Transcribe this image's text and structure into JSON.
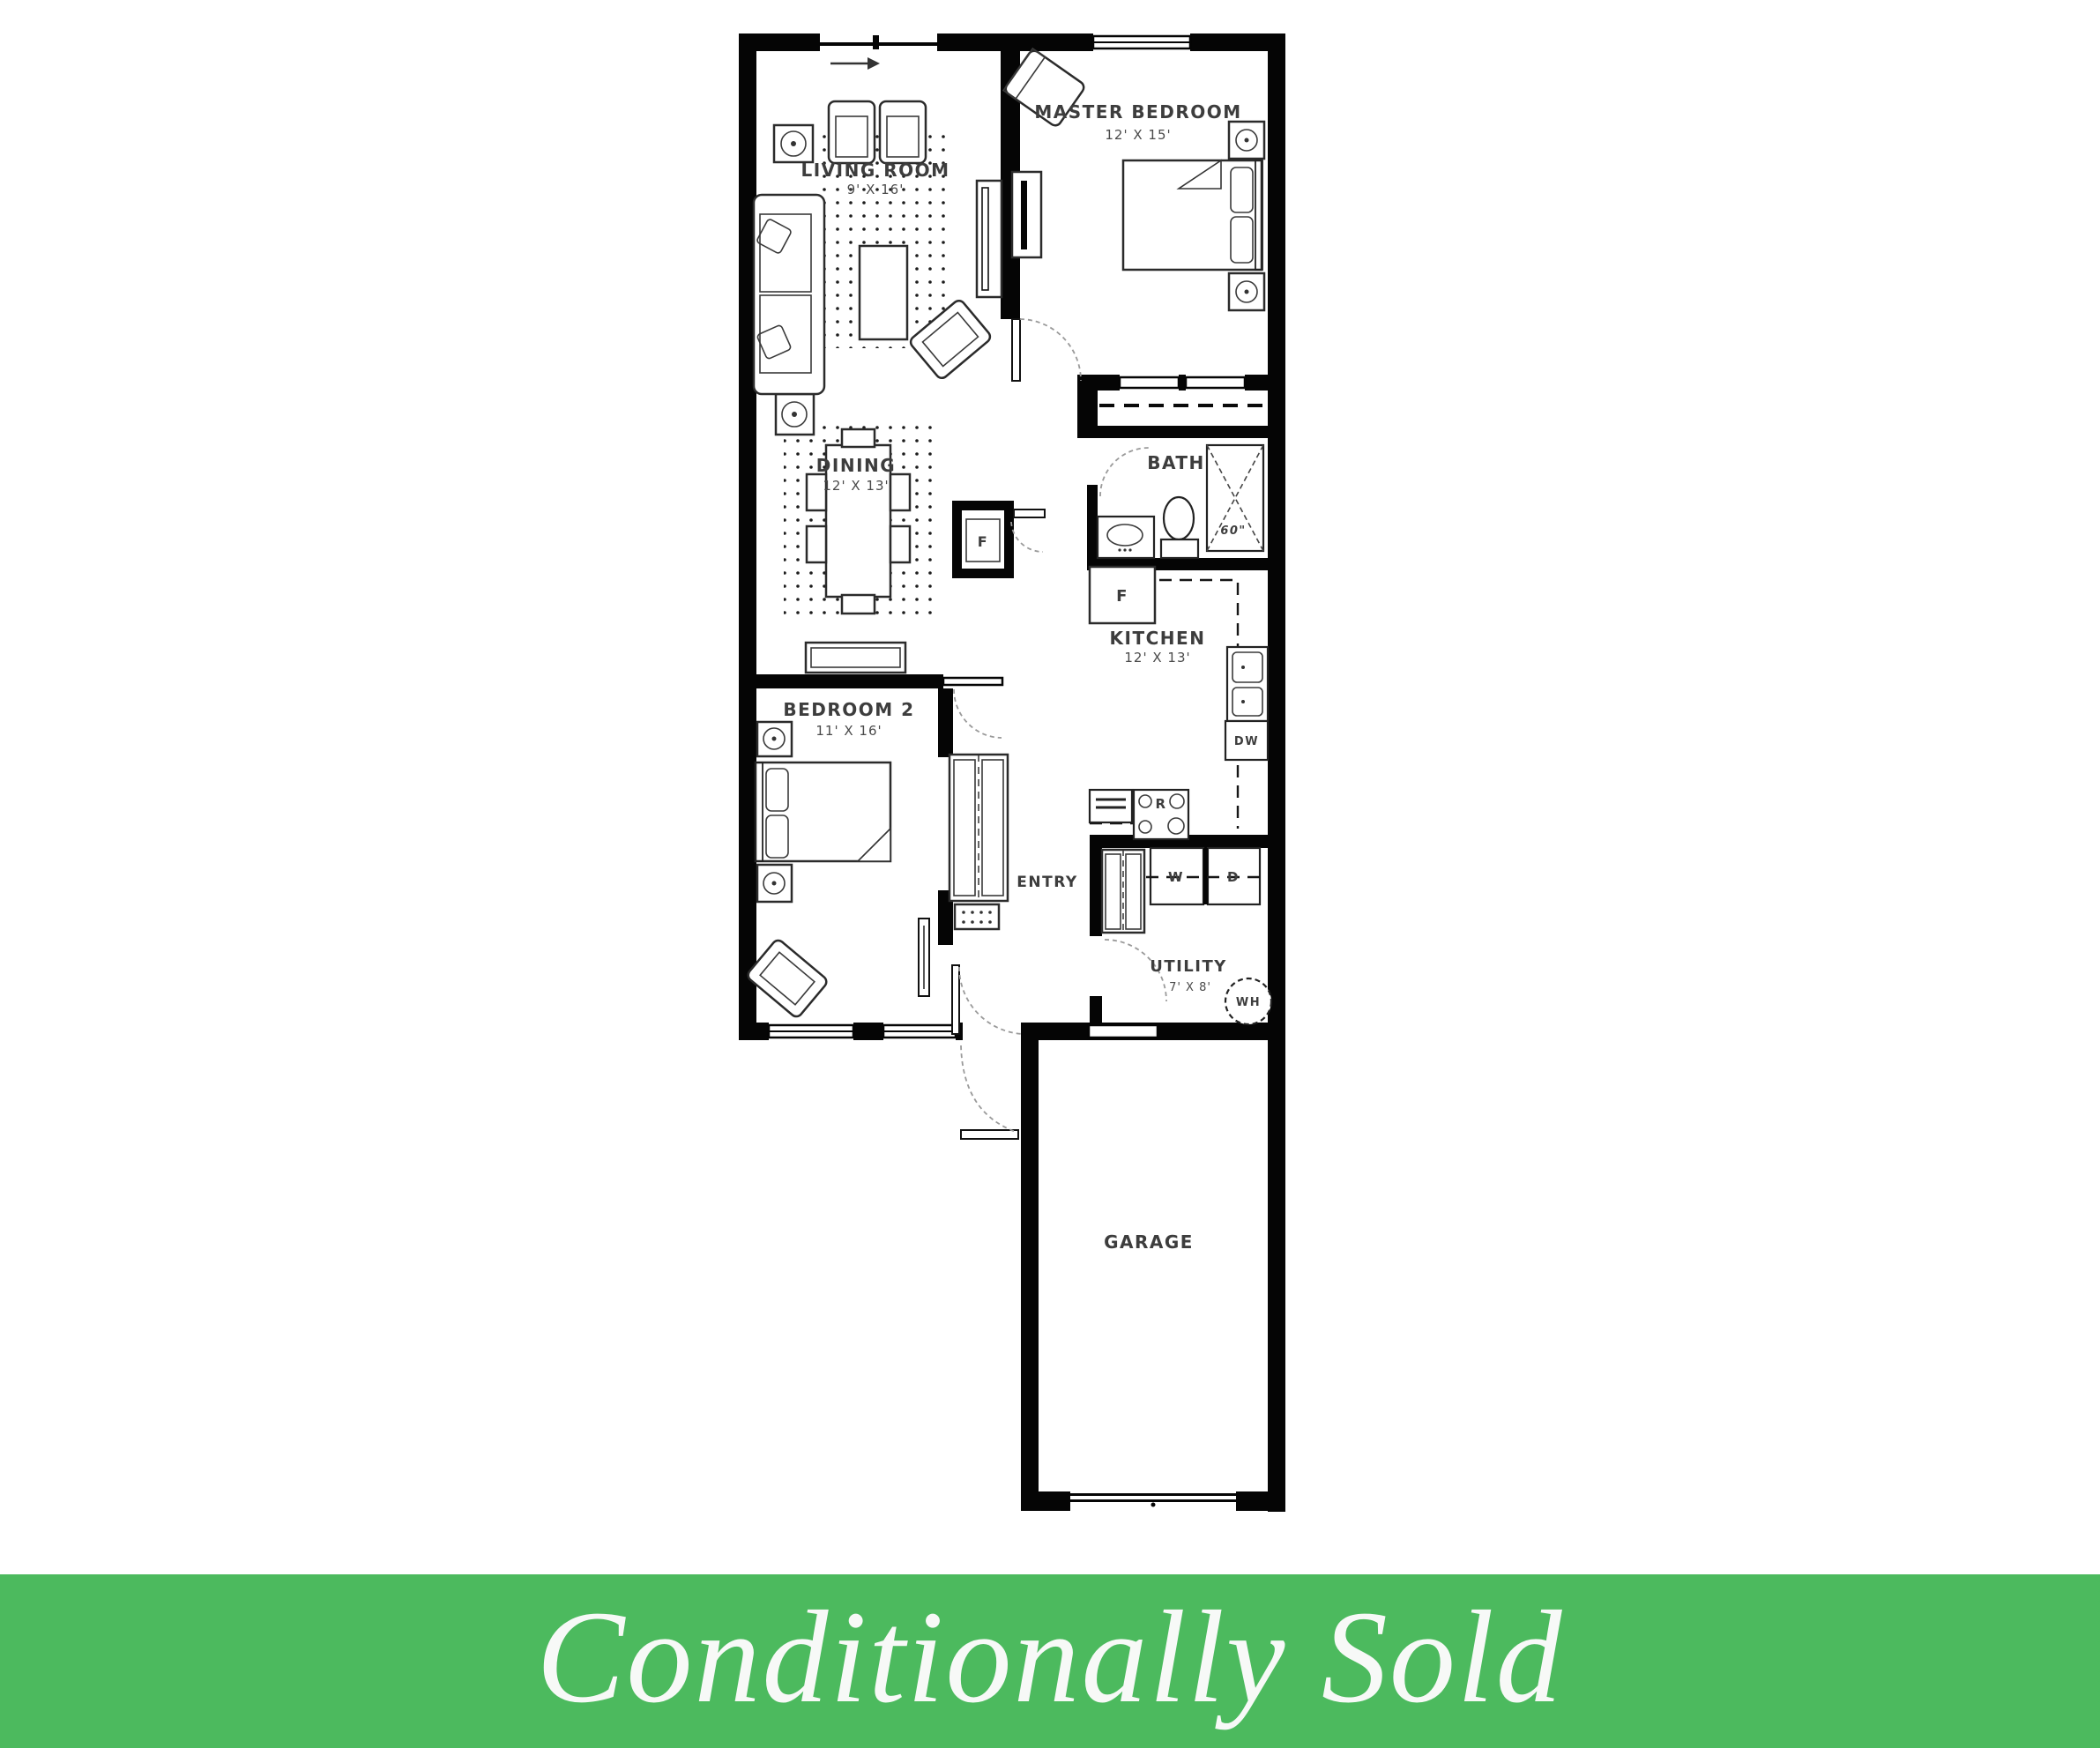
{
  "banner": {
    "label": "Conditionally Sold",
    "background_color": "#4cba5e",
    "text_color": "#f7f9f7"
  },
  "rooms": {
    "living_room": {
      "name": "LIVING ROOM",
      "dims": "9' X 16'"
    },
    "master_bedroom": {
      "name": "MASTER BEDROOM",
      "dims": "12' X 15'"
    },
    "dining": {
      "name": "DINING",
      "dims": "12' X 13'"
    },
    "bath": {
      "name": "BATH"
    },
    "kitchen": {
      "name": "KITCHEN",
      "dims": "12' X 13'"
    },
    "bedroom2": {
      "name": "BEDROOM 2",
      "dims": "11' X 16'"
    },
    "entry": {
      "name": "ENTRY"
    },
    "utility": {
      "name": "UTILITY",
      "dims": "7' X 8'"
    },
    "garage": {
      "name": "GARAGE"
    }
  },
  "fixtures": {
    "fridge": "F",
    "furnace": "F",
    "dishwasher": "DW",
    "range": "R",
    "washer": "W",
    "dryer": "D",
    "water_heater": "WH",
    "shower_size": "60\""
  }
}
